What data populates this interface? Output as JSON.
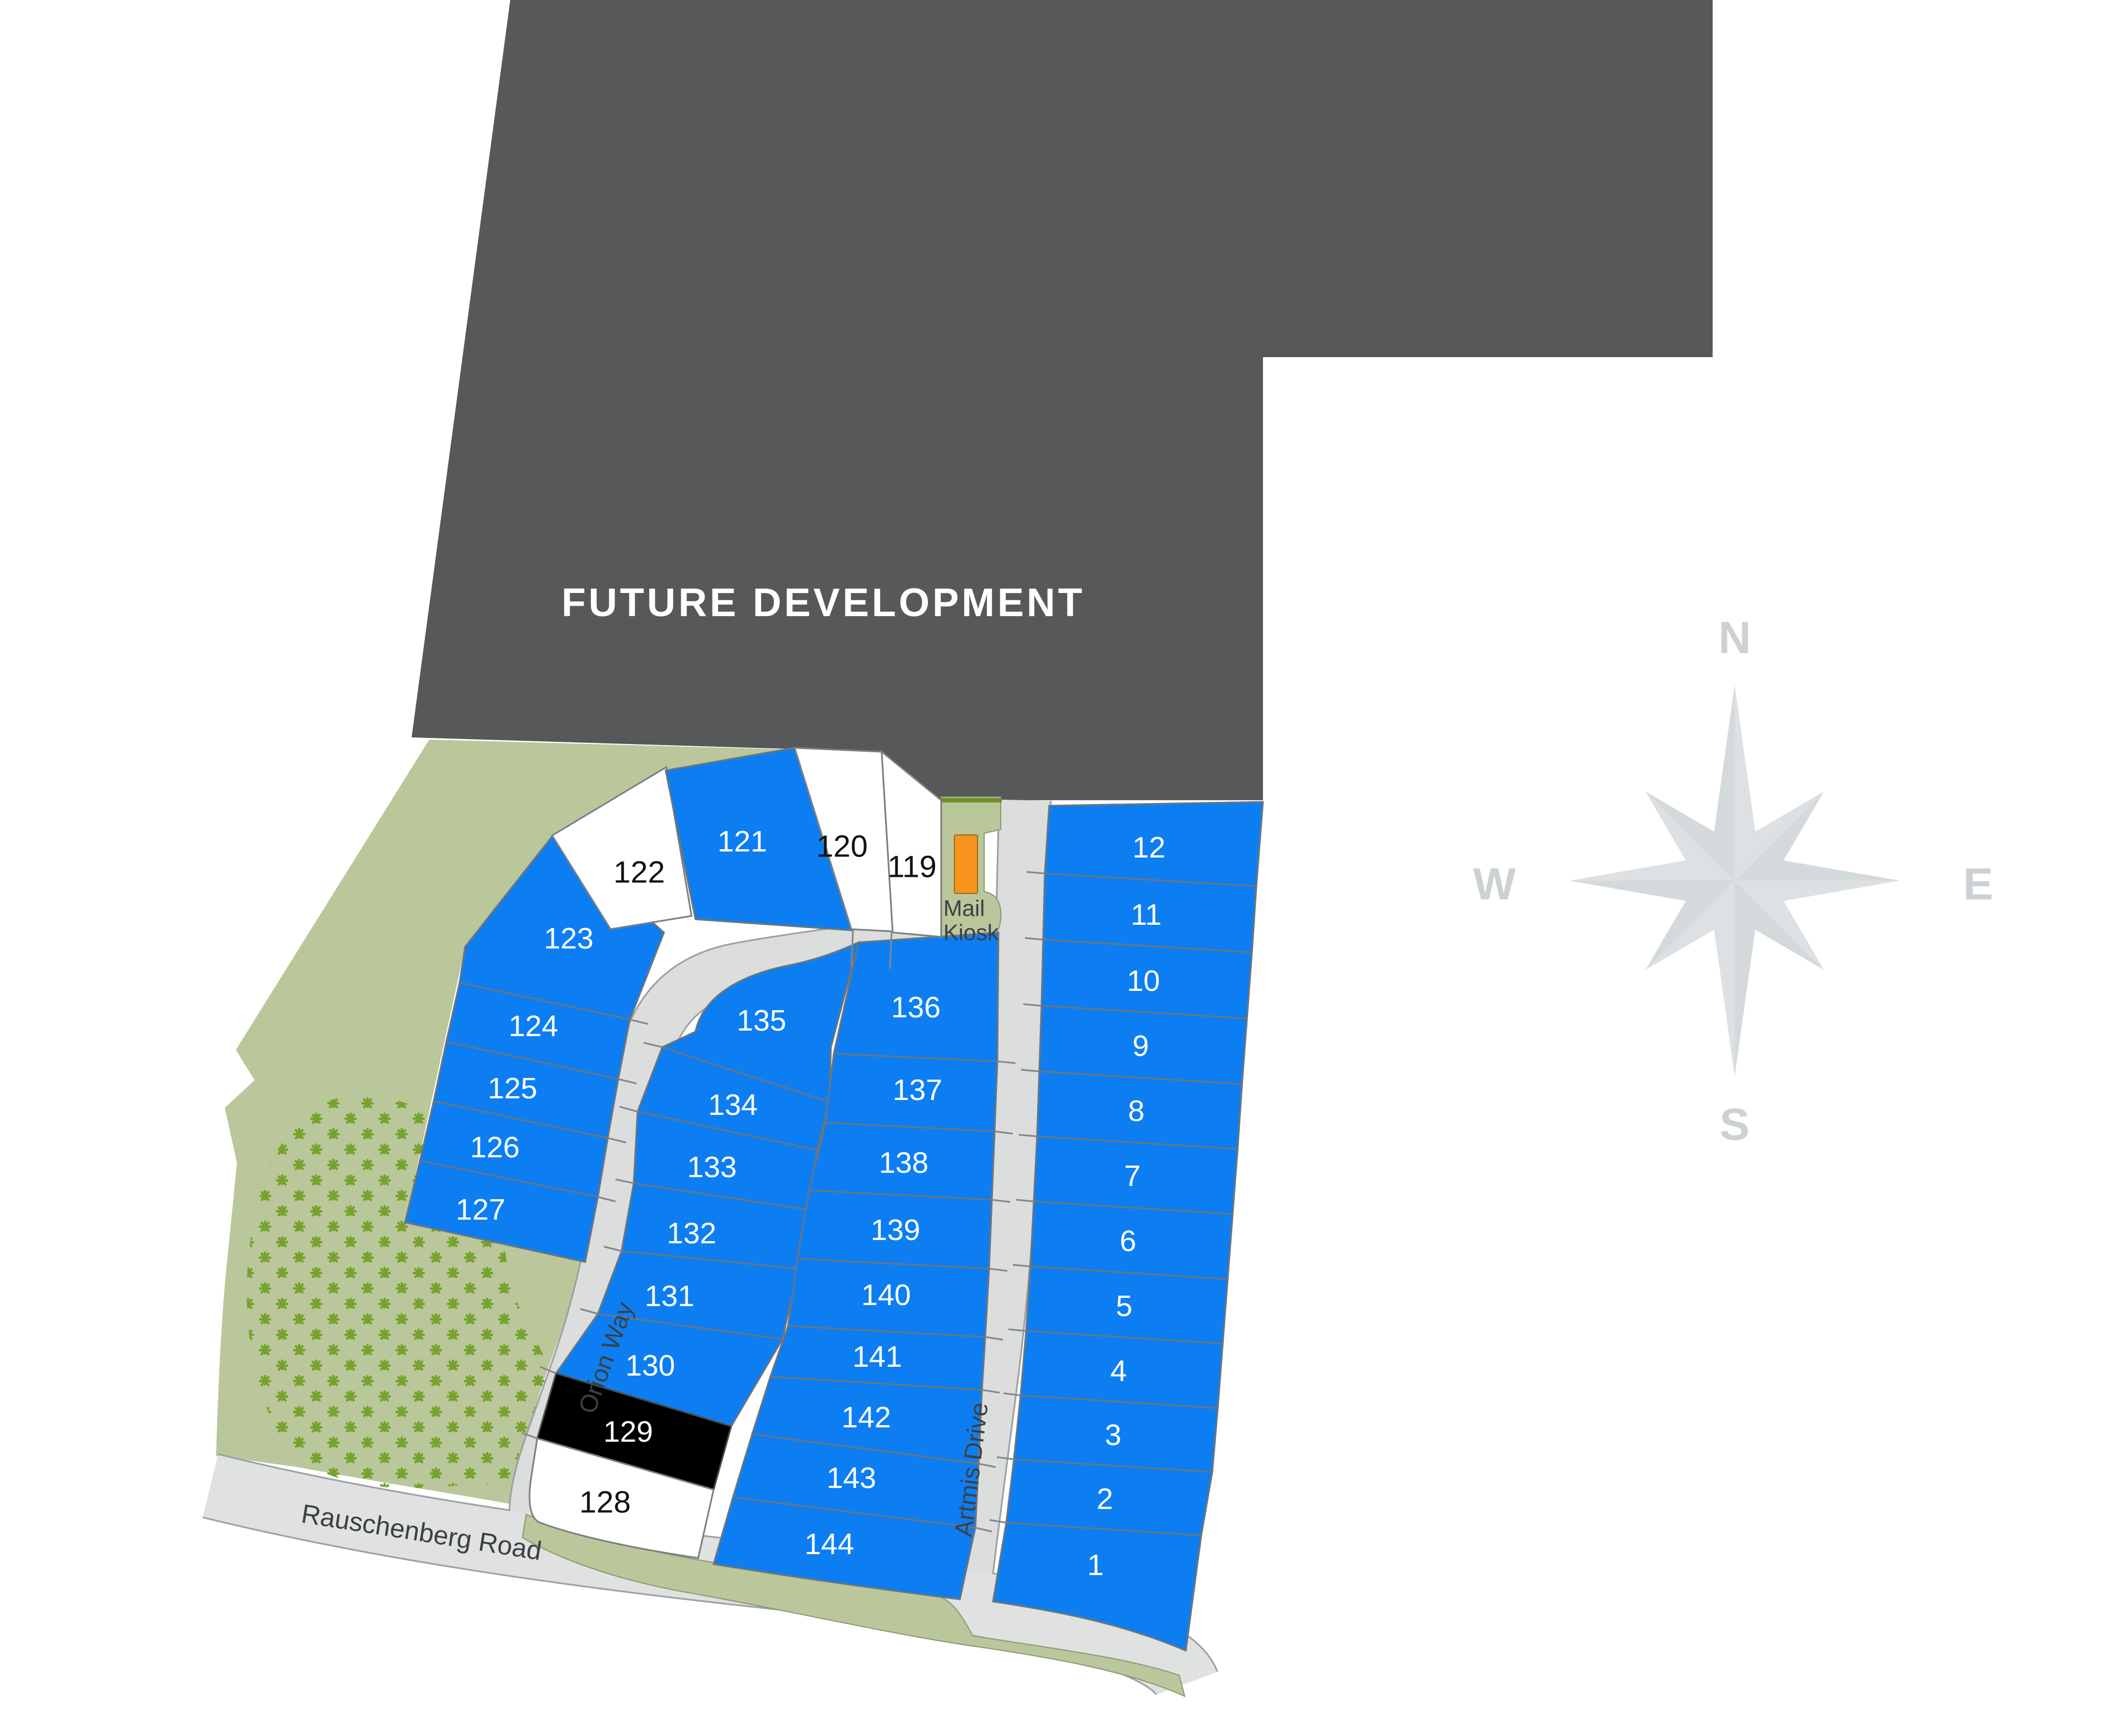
{
  "map_title": {
    "future_development": "FUTURE DEVELOPMENT"
  },
  "compass": {
    "north": "N",
    "south": "S",
    "east": "E",
    "west": "W"
  },
  "streets": {
    "orion": "Orion Way",
    "artmis": "Artmis Drive",
    "rauschenberg": "Rauschenberg Road"
  },
  "mail_kiosk": {
    "line1": "Mail",
    "line2": "Kiosk"
  },
  "palette": {
    "lot-blue": "#0d7ef2",
    "lot-white": "#ffffff",
    "lot-black": "#000000",
    "future": "#56585a",
    "green": "#b9c79b",
    "plant": "#76a22d",
    "road": "#dcdddd",
    "road-edge": "#9aa0a3",
    "olive": "#6e8f28",
    "orange": "#f7941e",
    "compass-a": "#dde1e3",
    "compass-b": "#d4d9db",
    "compass-text": "#ccd1d4",
    "label-dark": "#3c4043",
    "lot-line": "#6e757a"
  },
  "lots": [
    {
      "label": "1",
      "color": "blue"
    },
    {
      "label": "2",
      "color": "blue"
    },
    {
      "label": "3",
      "color": "blue"
    },
    {
      "label": "4",
      "color": "blue"
    },
    {
      "label": "5",
      "color": "blue"
    },
    {
      "label": "6",
      "color": "blue"
    },
    {
      "label": "7",
      "color": "blue"
    },
    {
      "label": "8",
      "color": "blue"
    },
    {
      "label": "9",
      "color": "blue"
    },
    {
      "label": "10",
      "color": "blue"
    },
    {
      "label": "11",
      "color": "blue"
    },
    {
      "label": "12",
      "color": "blue"
    },
    {
      "label": "119",
      "color": "white"
    },
    {
      "label": "120",
      "color": "white"
    },
    {
      "label": "121",
      "color": "blue"
    },
    {
      "label": "122",
      "color": "white"
    },
    {
      "label": "123",
      "color": "blue"
    },
    {
      "label": "124",
      "color": "blue"
    },
    {
      "label": "125",
      "color": "blue"
    },
    {
      "label": "126",
      "color": "blue"
    },
    {
      "label": "127",
      "color": "blue"
    },
    {
      "label": "128",
      "color": "white"
    },
    {
      "label": "129",
      "color": "black"
    },
    {
      "label": "130",
      "color": "blue"
    },
    {
      "label": "131",
      "color": "blue"
    },
    {
      "label": "132",
      "color": "blue"
    },
    {
      "label": "133",
      "color": "blue"
    },
    {
      "label": "134",
      "color": "blue"
    },
    {
      "label": "135",
      "color": "blue"
    },
    {
      "label": "136",
      "color": "blue"
    },
    {
      "label": "137",
      "color": "blue"
    },
    {
      "label": "138",
      "color": "blue"
    },
    {
      "label": "139",
      "color": "blue"
    },
    {
      "label": "140",
      "color": "blue"
    },
    {
      "label": "141",
      "color": "blue"
    },
    {
      "label": "142",
      "color": "blue"
    },
    {
      "label": "143",
      "color": "blue"
    },
    {
      "label": "144",
      "color": "blue"
    }
  ]
}
